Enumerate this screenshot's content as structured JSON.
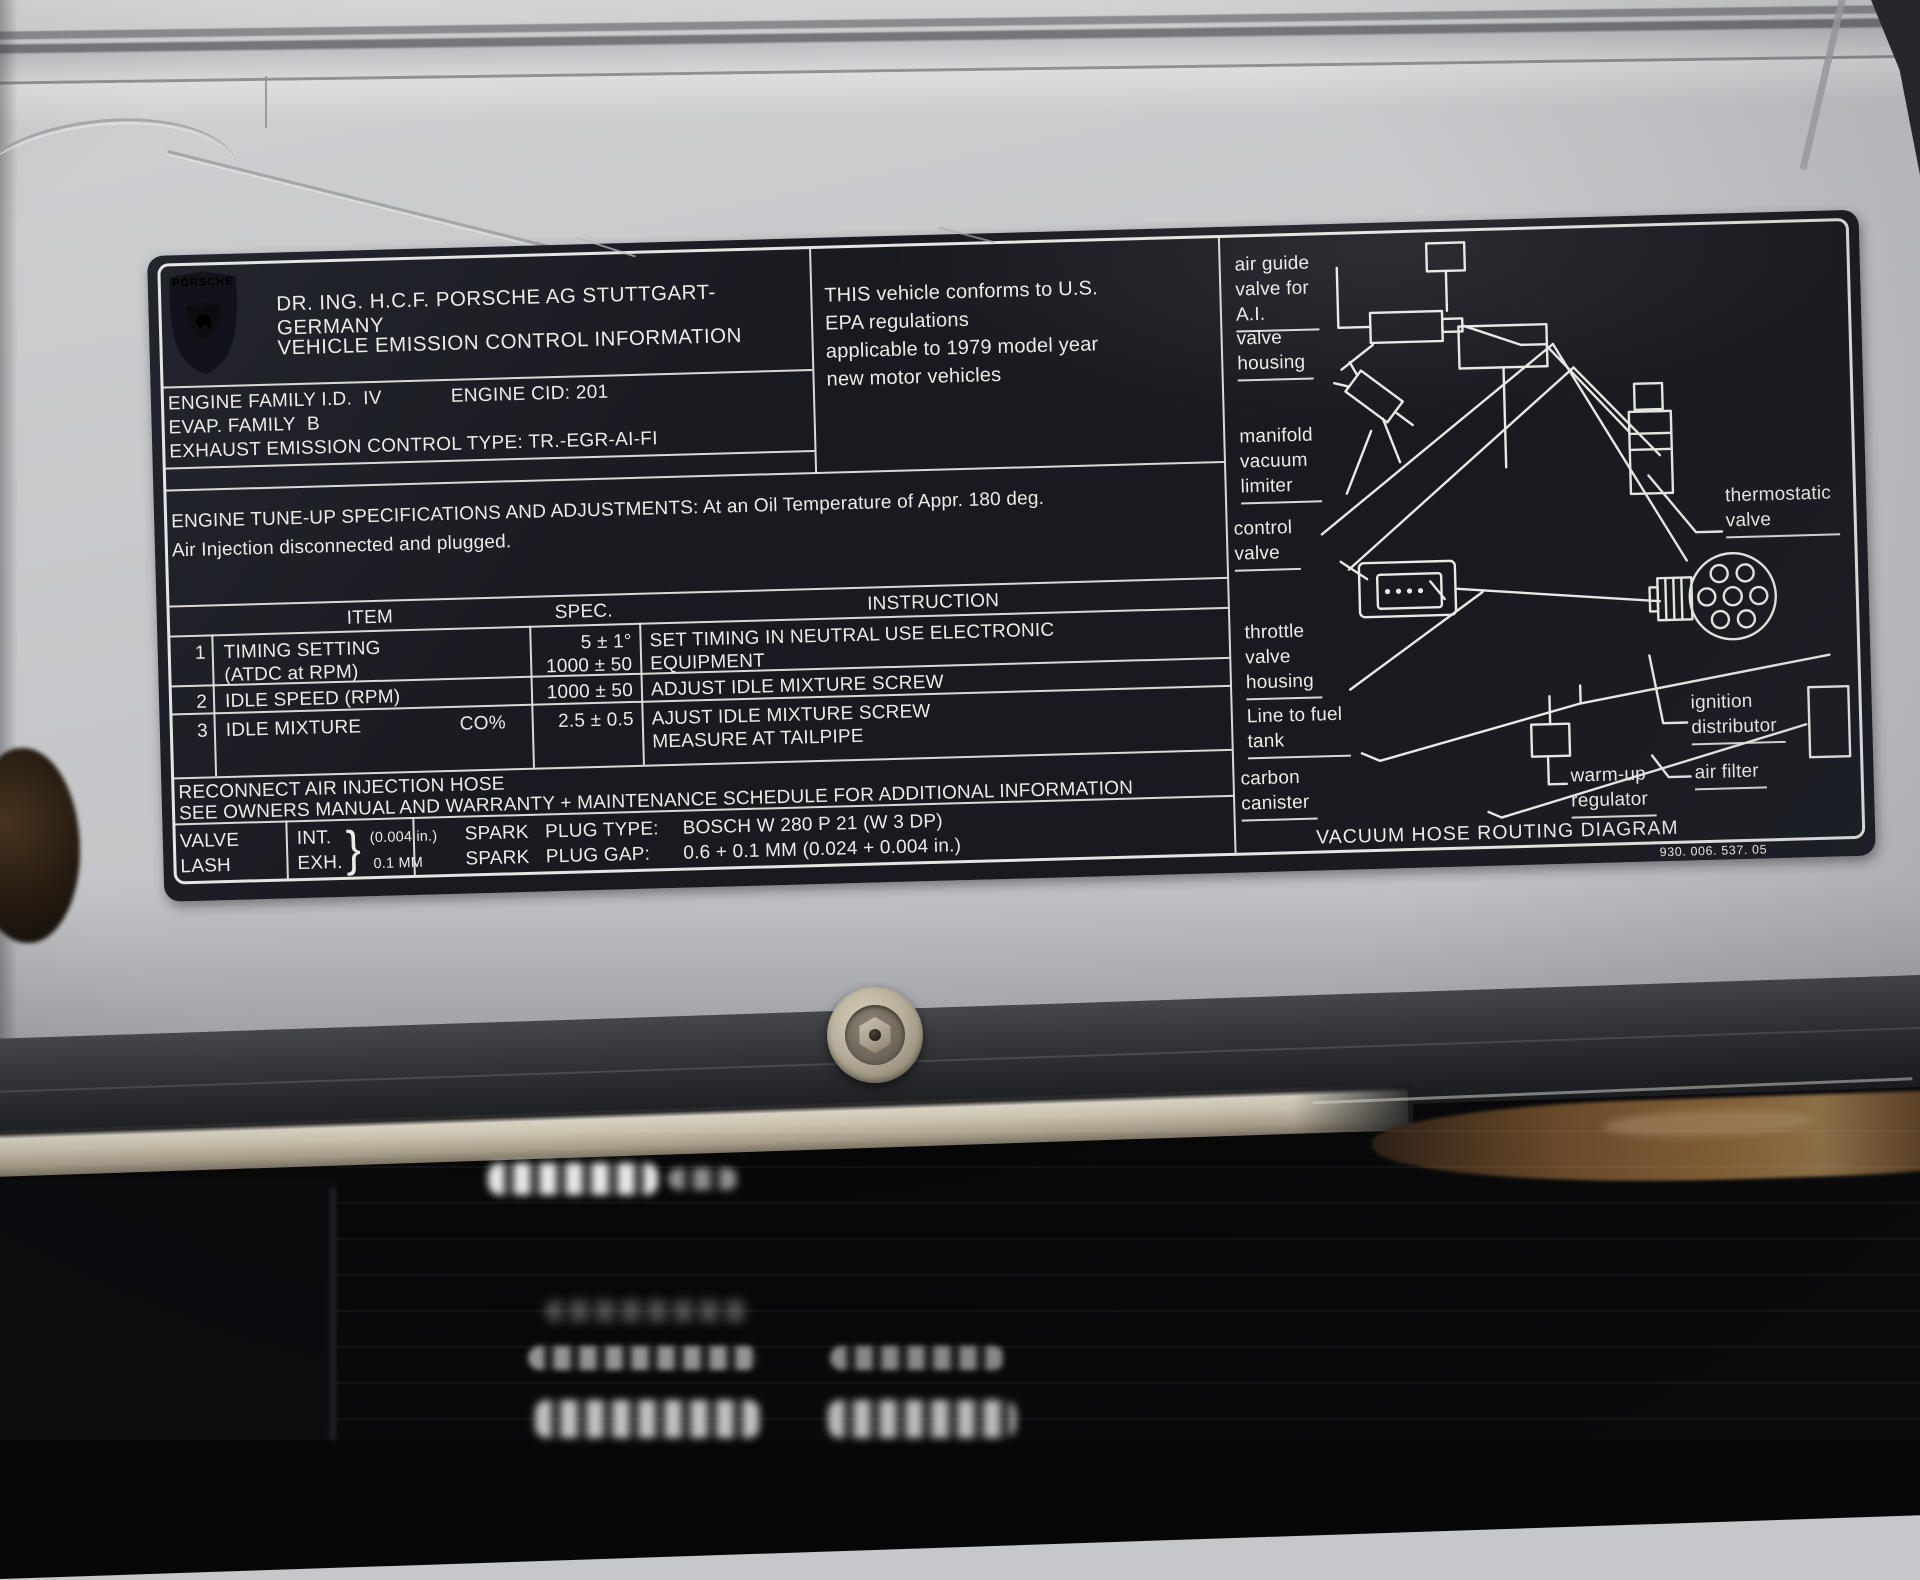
{
  "colors": {
    "label_background": "#1b1d23",
    "label_text": "#ebebe7",
    "panel_silver": "#c6c7ca",
    "trim_metal": "#c9c2ae",
    "rust": "#8a6438"
  },
  "label": {
    "crest": {
      "brand": "PORSCHE",
      "city": "STUTTGART"
    },
    "header": {
      "line1": "DR. ING. H.C.F. PORSCHE AG STUTTGART-GERMANY",
      "line2": "VEHICLE EMISSION CONTROL INFORMATION"
    },
    "engine_info": {
      "family": "ENGINE FAMILY I.D.  IV",
      "cid": "ENGINE CID: 201",
      "evap": "EVAP. FAMILY  B",
      "exhaust": "EXHAUST EMISSION CONTROL TYPE: TR.-EGR-AI-FI"
    },
    "epa_statement": "THIS vehicle conforms to U.S.\nEPA regulations\napplicable to 1979 model year\nnew motor vehicles",
    "tuneup_heading": "ENGINE TUNE-UP SPECIFICATIONS AND ADJUSTMENTS: At an Oil Temperature of Appr. 180 deg.\nAir Injection disconnected and plugged.",
    "spec_table": {
      "col_item": "ITEM",
      "col_spec": "SPEC.",
      "col_instruction": "INSTRUCTION",
      "rows": [
        {
          "num": "1",
          "item": "TIMING SETTING\n(ATDC at RPM)",
          "spec": "5 ± 1°\n1000 ± 50",
          "instruction": "SET TIMING IN NEUTRAL USE ELECTRONIC\nEQUIPMENT"
        },
        {
          "num": "2",
          "item": "IDLE SPEED (RPM)",
          "spec": "1000 ± 50",
          "instruction": "ADJUST IDLE MIXTURE SCREW"
        },
        {
          "num": "3",
          "item": "IDLE MIXTURE",
          "item_unit": "CO%",
          "spec": "2.5 ± 0.5",
          "instruction": "AJUST IDLE MIXTURE SCREW\nMEASURE AT TAILPIPE"
        }
      ]
    },
    "notes": "RECONNECT AIR INJECTION HOSE\nSEE OWNERS MANUAL AND WARRANTY + MAINTENANCE SCHEDULE FOR ADDITIONAL INFORMATION",
    "valve_lash": {
      "word1": "VALVE",
      "word2": "LASH",
      "int_label": "INT.",
      "exh_label": "EXH.",
      "brace": "}",
      "int_value": "(0.004 in.)",
      "exh_value": "0.1 MM",
      "spark_type_label": "SPARK   PLUG TYPE:",
      "spark_type_value": "BOSCH W 280 P 21 (W 3 DP)",
      "spark_gap_label": "SPARK   PLUG GAP:",
      "spark_gap_value": "0.6 + 0.1 MM (0.024 + 0.004 in.)"
    },
    "diagram": {
      "callouts": {
        "air_guide": "air guide\nvalve for\nA.I.",
        "valve_housing": "valve\nhousing",
        "manifold": "manifold\nvacuum\nlimiter",
        "control_valve": "control\nvalve",
        "throttle": "throttle\nvalve\nhousing",
        "fuel_tank": "Line to fuel\ntank",
        "carbon": "carbon\ncanister",
        "thermostatic": "thermostatic\nvalve",
        "ignition": "ignition\ndistributor",
        "air_filter": "air filter",
        "warm_up": "warm-up\nregulator"
      },
      "caption": "VACUUM HOSE ROUTING DIAGRAM",
      "part_number": "930. 006. 537. 05"
    }
  }
}
